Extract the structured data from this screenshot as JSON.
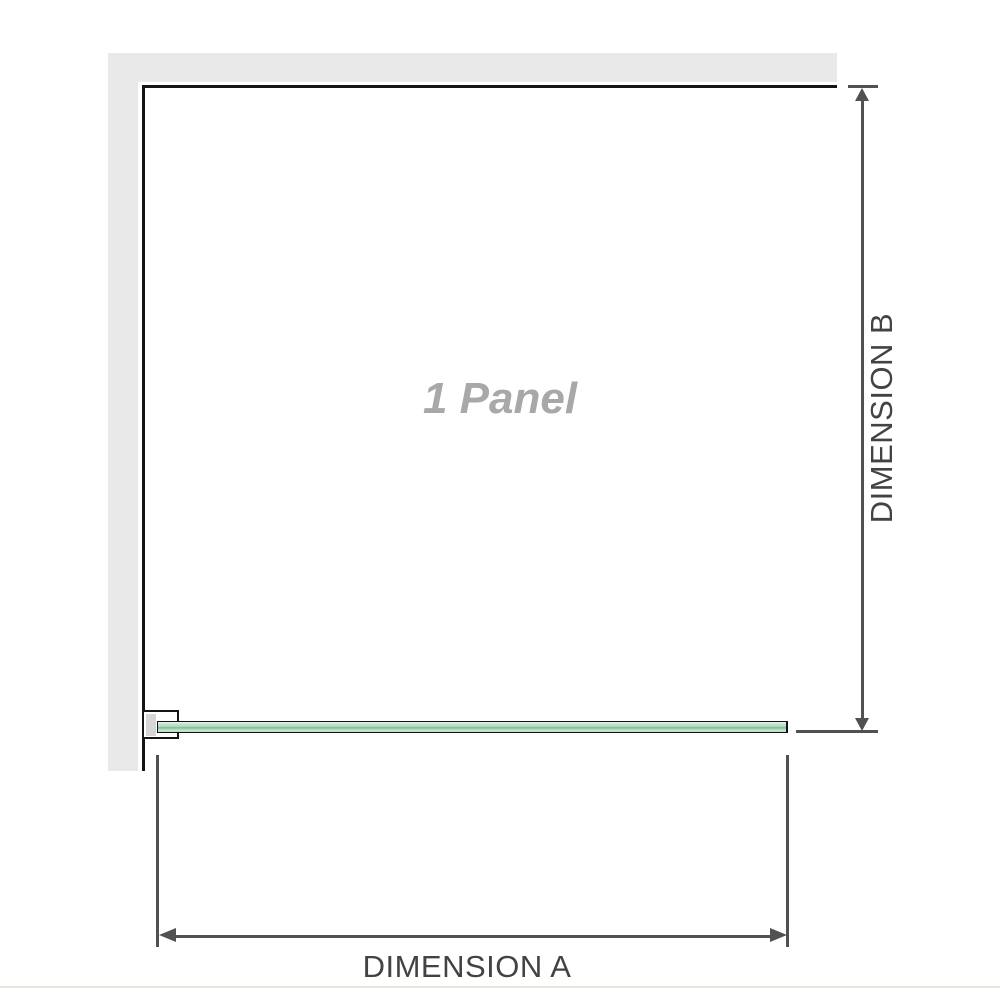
{
  "diagram": {
    "panel_label": "1 Panel",
    "dimension_a_label": "DIMENSION A",
    "dimension_b_label": "DIMENSION B"
  },
  "icons": {
    "dimension_b_top": "arrow-up-icon",
    "dimension_b_bottom": "arrow-down-icon",
    "dimension_a_left": "arrow-left-icon",
    "dimension_a_right": "arrow-right-icon"
  },
  "colors": {
    "background": "#ffffff",
    "wall_fill": "#e9e9e9",
    "panel_outline": "#141414",
    "dimension_line": "#515151",
    "dimension_text": "#434343",
    "panel_label_text": "#a8a8a8",
    "bracket_insert": "#d6d6d6",
    "glass_light": "#e9f5ec",
    "glass_mid": "#aedcbd",
    "glass_dark": "#7fb997",
    "baseline_rule": "#eae6de"
  }
}
